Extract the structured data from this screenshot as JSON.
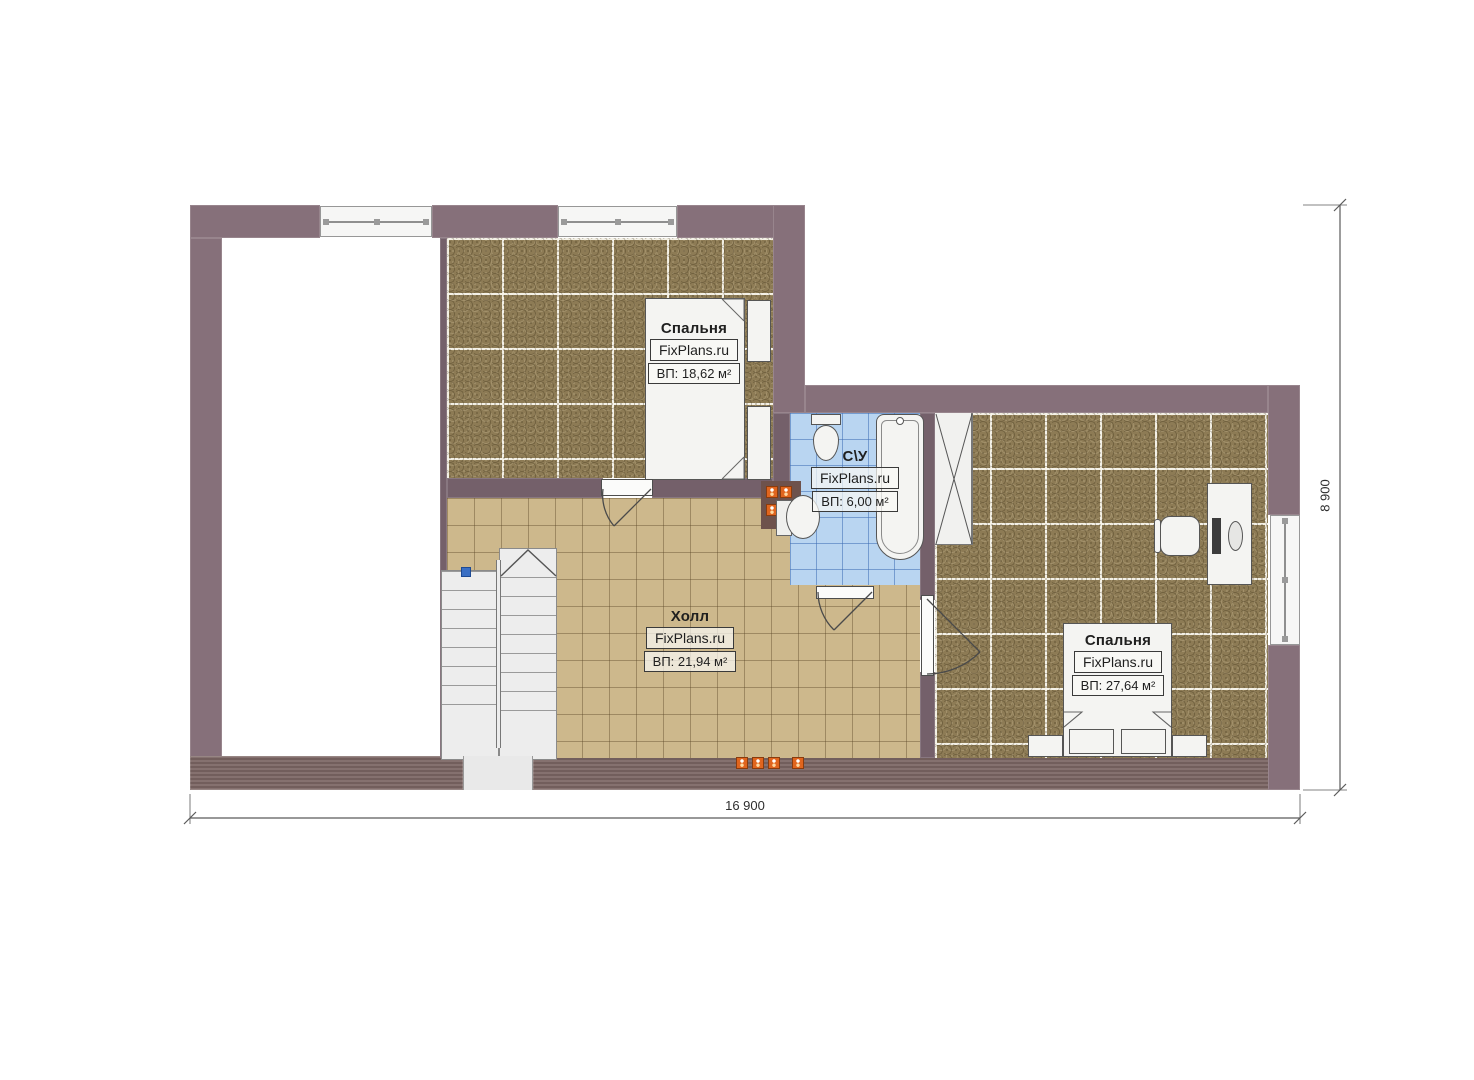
{
  "plan": {
    "rooms": [
      {
        "id": "bedroom-1",
        "name": "Спальня",
        "brand": "FixPlans.ru",
        "area": "ВП: 18,62 м²"
      },
      {
        "id": "bathroom",
        "name": "С\\У",
        "brand": "FixPlans.ru",
        "area": "ВП: 6,00 м²"
      },
      {
        "id": "hall",
        "name": "Холл",
        "brand": "FixPlans.ru",
        "area": "ВП: 21,94 м²"
      },
      {
        "id": "bedroom-2",
        "name": "Спальня",
        "brand": "FixPlans.ru",
        "area": "ВП: 27,64 м²"
      }
    ],
    "dimensions": {
      "width": "16 900",
      "height": "8 900"
    },
    "colors": {
      "wall": "#86707A",
      "bottom_wall": "#7C6664",
      "bedroom_floor": "#8D7B55",
      "hall_floor": "#CDB88C",
      "bath_floor": "#B9D5F1",
      "outlet": "#E0651E",
      "stair_marker": "#3A6FC4"
    }
  }
}
